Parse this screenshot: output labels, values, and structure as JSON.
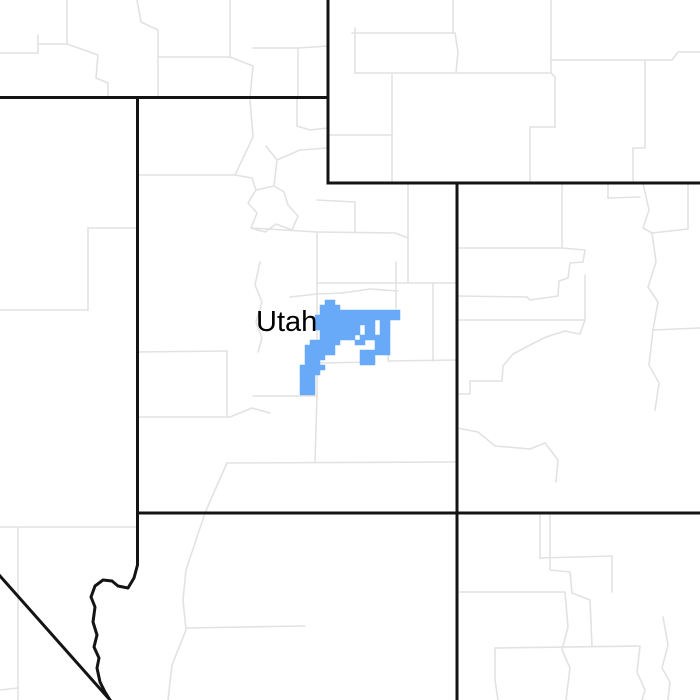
{
  "map": {
    "background_color": "#ffffff",
    "county_line_color": "#e2e2e2",
    "county_line_width": 1.6,
    "state_line_color": "#141414",
    "state_line_width": 3,
    "label": {
      "text": "Utah",
      "x": 256,
      "y": 306,
      "font_size": 29,
      "color": "#000000"
    },
    "alert_region": {
      "name": "weather-alert-highlight",
      "color": "#68aaf8",
      "cell_size": 5,
      "origin_x": 300,
      "origin_y": 300,
      "rows": [
        ".....##..............",
        "....####.............",
        "....################.",
        "...#################.",
        "...############.##...",
        "...#########.##.##...",
        "....########.##.##...",
        "....#######.######...",
        "..######...##..###...",
        ".######........###...",
        ".######.....######...",
        ".####.......###......",
        ".###........###......",
        "#####................",
        "####.................",
        "###..................",
        "###..................",
        "###..................",
        "###.................."
      ]
    },
    "state_borders": [
      [
        [
          0,
          97.5
        ],
        [
          328,
          97.5
        ]
      ],
      [
        [
          328,
          0
        ],
        [
          328,
          183
        ]
      ],
      [
        [
          328,
          183
        ],
        [
          700,
          183
        ]
      ],
      [
        [
          457,
          183
        ],
        [
          457,
          700
        ]
      ],
      [
        [
          137.5,
          97.5
        ],
        [
          137.5,
          513
        ]
      ],
      [
        [
          137.5,
          513
        ],
        [
          700,
          513
        ]
      ],
      [
        [
          137.5,
          513
        ],
        [
          137.5,
          565
        ],
        [
          134,
          578
        ],
        [
          128,
          588
        ],
        [
          118,
          586
        ],
        [
          112,
          581
        ],
        [
          103,
          580
        ],
        [
          95,
          586
        ],
        [
          91,
          597
        ],
        [
          95,
          607
        ],
        [
          93,
          622
        ],
        [
          97,
          635
        ],
        [
          94,
          647
        ],
        [
          99,
          658
        ],
        [
          97,
          668
        ],
        [
          100,
          682
        ],
        [
          105,
          692
        ],
        [
          110,
          700
        ]
      ],
      [
        [
          0,
          576
        ],
        [
          110,
          700
        ]
      ]
    ],
    "county_borders": [
      [
        [
          0,
          310
        ],
        [
          88,
          310
        ]
      ],
      [
        [
          88,
          228
        ],
        [
          88,
          310
        ]
      ],
      [
        [
          88,
          228
        ],
        [
          137.5,
          228
        ]
      ],
      [
        [
          0,
          527
        ],
        [
          137.5,
          527
        ]
      ],
      [
        [
          18,
          527
        ],
        [
          18,
          700
        ]
      ],
      [
        [
          0,
          690
        ],
        [
          18,
          688
        ]
      ],
      [
        [
          0,
          53
        ],
        [
          38,
          53
        ]
      ],
      [
        [
          38,
          35
        ],
        [
          38,
          53
        ]
      ],
      [
        [
          38,
          44
        ],
        [
          67,
          44
        ]
      ],
      [
        [
          67,
          0
        ],
        [
          67,
          44
        ]
      ],
      [
        [
          67,
          44
        ],
        [
          98,
          55
        ],
        [
          96,
          78
        ],
        [
          108,
          83
        ],
        [
          108,
          97.5
        ]
      ],
      [
        [
          137,
          0
        ],
        [
          141,
          22
        ],
        [
          158,
          30
        ]
      ],
      [
        [
          158,
          30
        ],
        [
          158,
          97.5
        ]
      ],
      [
        [
          158,
          57
        ],
        [
          230,
          57
        ]
      ],
      [
        [
          230,
          0
        ],
        [
          230,
          57
        ]
      ],
      [
        [
          230,
          57
        ],
        [
          253,
          66
        ],
        [
          250,
          97.5
        ]
      ],
      [
        [
          253,
          48
        ],
        [
          298,
          48
        ],
        [
          298,
          97.5
        ]
      ],
      [
        [
          298,
          48
        ],
        [
          328,
          46
        ]
      ],
      [
        [
          352,
          33
        ],
        [
          455,
          33
        ]
      ],
      [
        [
          453,
          0
        ],
        [
          453,
          33
        ]
      ],
      [
        [
          455,
          33
        ],
        [
          458,
          52
        ],
        [
          456,
          73
        ]
      ],
      [
        [
          355,
          28
        ],
        [
          355,
          73
        ]
      ],
      [
        [
          355,
          73
        ],
        [
          551,
          73
        ]
      ],
      [
        [
          551,
          0
        ],
        [
          551,
          73
        ]
      ],
      [
        [
          551,
          60
        ],
        [
          672,
          60
        ],
        [
          678,
          52
        ],
        [
          700,
          52
        ]
      ],
      [
        [
          551,
          73
        ],
        [
          555,
          77
        ],
        [
          555,
          127
        ]
      ],
      [
        [
          530,
          127
        ],
        [
          555,
          127
        ]
      ],
      [
        [
          530,
          127
        ],
        [
          530,
          183
        ]
      ],
      [
        [
          645,
          60
        ],
        [
          645,
          148
        ]
      ],
      [
        [
          633,
          148
        ],
        [
          645,
          148
        ]
      ],
      [
        [
          633,
          148
        ],
        [
          633,
          183
        ]
      ],
      [
        [
          392,
          75
        ],
        [
          392,
          183
        ]
      ],
      [
        [
          328,
          135
        ],
        [
          392,
          135
        ]
      ],
      [
        [
          137.5,
          175
        ],
        [
          235,
          175
        ]
      ],
      [
        [
          235,
          175
        ],
        [
          253,
          137
        ],
        [
          250,
          100
        ]
      ],
      [
        [
          235,
          175
        ],
        [
          252,
          178
        ],
        [
          256,
          190
        ],
        [
          248,
          203
        ],
        [
          257,
          213
        ],
        [
          251,
          228
        ]
      ],
      [
        [
          256,
          190
        ],
        [
          274,
          186
        ],
        [
          284,
          192
        ],
        [
          288,
          205
        ],
        [
          298,
          216
        ],
        [
          292,
          230
        ],
        [
          276,
          224
        ],
        [
          265,
          232
        ],
        [
          251,
          228
        ]
      ],
      [
        [
          274,
          186
        ],
        [
          277,
          160
        ],
        [
          266,
          146
        ]
      ],
      [
        [
          277,
          160
        ],
        [
          300,
          150
        ],
        [
          328,
          148
        ]
      ],
      [
        [
          297,
          97.5
        ],
        [
          297,
          126
        ],
        [
          310,
          130
        ],
        [
          328,
          128
        ]
      ],
      [
        [
          251,
          228
        ],
        [
          317,
          232
        ]
      ],
      [
        [
          317,
          232
        ],
        [
          317,
          396
        ]
      ],
      [
        [
          253,
          396
        ],
        [
          317,
          396
        ]
      ],
      [
        [
          317,
          200
        ],
        [
          355,
          202
        ],
        [
          355,
          232
        ]
      ],
      [
        [
          317,
          232
        ],
        [
          395,
          233
        ],
        [
          408,
          238
        ]
      ],
      [
        [
          408,
          185
        ],
        [
          408,
          283
        ]
      ],
      [
        [
          317,
          283
        ],
        [
          457,
          283
        ]
      ],
      [
        [
          433,
          283
        ],
        [
          433,
          361
        ]
      ],
      [
        [
          388,
          361
        ],
        [
          457,
          360
        ]
      ],
      [
        [
          320,
          363
        ],
        [
          375,
          362
        ]
      ],
      [
        [
          260,
          262
        ],
        [
          255,
          285
        ],
        [
          262,
          302
        ],
        [
          256,
          322
        ],
        [
          262,
          338
        ],
        [
          258,
          352
        ]
      ],
      [
        [
          290,
          297
        ],
        [
          317,
          294
        ],
        [
          342,
          293
        ]
      ],
      [
        [
          342,
          293
        ],
        [
          370,
          289
        ],
        [
          398,
          291
        ]
      ],
      [
        [
          396,
          262
        ],
        [
          396,
          308
        ]
      ],
      [
        [
          390,
          322
        ],
        [
          388,
          360
        ]
      ],
      [
        [
          137.5,
          352
        ],
        [
          227,
          351
        ]
      ],
      [
        [
          227,
          351
        ],
        [
          227,
          417
        ]
      ],
      [
        [
          137.5,
          417
        ],
        [
          230,
          417
        ],
        [
          252,
          408
        ],
        [
          270,
          413
        ]
      ],
      [
        [
          227,
          463
        ],
        [
          457,
          462
        ]
      ],
      [
        [
          317,
          396
        ],
        [
          315,
          462
        ]
      ],
      [
        [
          227,
          463
        ],
        [
          215,
          490
        ],
        [
          205,
          513
        ],
        [
          196,
          540
        ],
        [
          186,
          570
        ],
        [
          183,
          600
        ],
        [
          186,
          630
        ],
        [
          172,
          665
        ],
        [
          168,
          700
        ]
      ],
      [
        [
          550,
          513
        ],
        [
          550,
          570
        ],
        [
          570,
          572
        ],
        [
          572,
          593
        ],
        [
          590,
          600
        ],
        [
          592,
          646
        ]
      ],
      [
        [
          495,
          648
        ],
        [
          640,
          646
        ]
      ],
      [
        [
          495,
          648
        ],
        [
          495,
          680
        ],
        [
          498,
          700
        ]
      ],
      [
        [
          640,
          646
        ],
        [
          637,
          672
        ],
        [
          645,
          690
        ],
        [
          642,
          700
        ]
      ],
      [
        [
          186,
          628
        ],
        [
          305,
          626
        ]
      ],
      [
        [
          460,
          592
        ],
        [
          565,
          592
        ]
      ],
      [
        [
          565,
          592
        ],
        [
          568,
          627
        ],
        [
          562,
          650
        ],
        [
          570,
          668
        ],
        [
          566,
          700
        ]
      ],
      [
        [
          540,
          513
        ],
        [
          540,
          558
        ]
      ],
      [
        [
          540,
          558
        ],
        [
          612,
          556
        ]
      ],
      [
        [
          612,
          556
        ],
        [
          612,
          592
        ]
      ],
      [
        [
          663,
          617
        ],
        [
          668,
          645
        ],
        [
          662,
          668
        ],
        [
          670,
          682
        ],
        [
          668,
          700
        ]
      ],
      [
        [
          457,
          248
        ],
        [
          562,
          248
        ]
      ],
      [
        [
          562,
          183
        ],
        [
          562,
          248
        ]
      ],
      [
        [
          562,
          248
        ],
        [
          585,
          250
        ],
        [
          583,
          262
        ],
        [
          570,
          263
        ],
        [
          568,
          278
        ],
        [
          559,
          281
        ],
        [
          558,
          296
        ]
      ],
      [
        [
          457,
          296
        ],
        [
          527,
          297
        ],
        [
          530,
          300
        ],
        [
          558,
          296
        ]
      ],
      [
        [
          457,
          320
        ],
        [
          585,
          320
        ]
      ],
      [
        [
          585,
          275
        ],
        [
          585,
          320
        ]
      ],
      [
        [
          585,
          320
        ],
        [
          580,
          334
        ],
        [
          565,
          331
        ],
        [
          546,
          337
        ],
        [
          532,
          344
        ],
        [
          513,
          354
        ],
        [
          503,
          366
        ],
        [
          502,
          381
        ],
        [
          470,
          381
        ],
        [
          470,
          394
        ],
        [
          457,
          394
        ]
      ],
      [
        [
          608,
          183
        ],
        [
          608,
          198
        ]
      ],
      [
        [
          608,
          198
        ],
        [
          640,
          197
        ]
      ],
      [
        [
          643,
          183
        ],
        [
          649,
          210
        ],
        [
          643,
          228
        ],
        [
          652,
          233
        ]
      ],
      [
        [
          652,
          233
        ],
        [
          688,
          229
        ]
      ],
      [
        [
          688,
          183
        ],
        [
          688,
          229
        ]
      ],
      [
        [
          652,
          233
        ],
        [
          656,
          262
        ],
        [
          648,
          287
        ],
        [
          658,
          302
        ],
        [
          653,
          330
        ]
      ],
      [
        [
          653,
          330
        ],
        [
          700,
          328
        ]
      ],
      [
        [
          653,
          330
        ],
        [
          649,
          365
        ],
        [
          659,
          383
        ],
        [
          655,
          410
        ]
      ],
      [
        [
          457,
          428
        ],
        [
          478,
          432
        ],
        [
          495,
          446
        ],
        [
          530,
          449
        ],
        [
          545,
          443
        ]
      ],
      [
        [
          545,
          443
        ],
        [
          558,
          460
        ],
        [
          556,
          482
        ]
      ]
    ]
  }
}
